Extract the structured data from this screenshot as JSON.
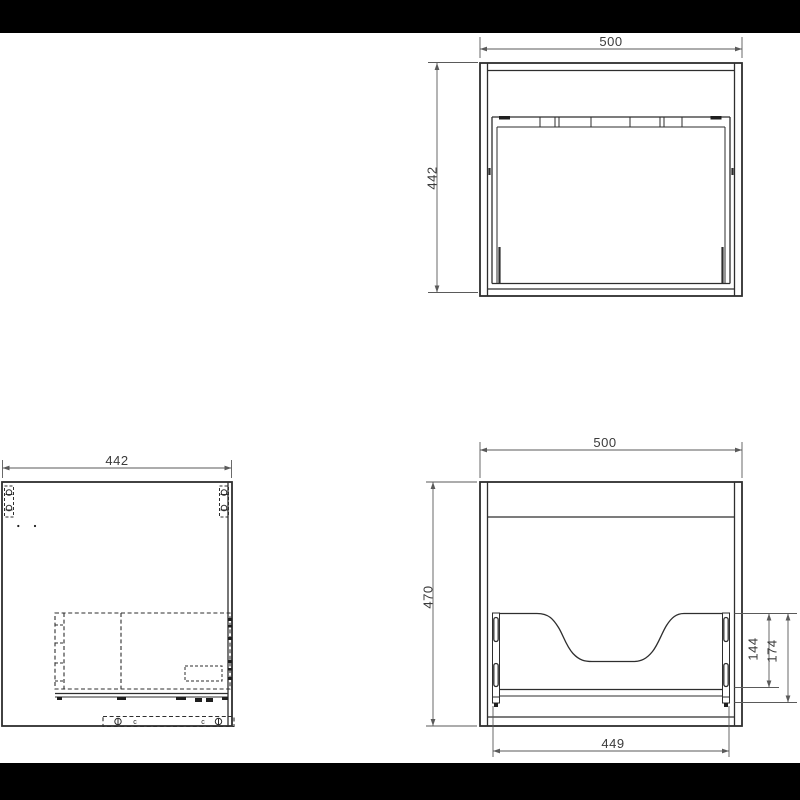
{
  "drawing": {
    "background": "#ffffff",
    "letterbox_color": "#000000",
    "line_color": "#2e2e2e",
    "dim_line_color": "#5a5a5a",
    "dim_text_color": "#3b3b3b",
    "views": {
      "top": {
        "width": "500",
        "depth": "442"
      },
      "side": {
        "depth": "442",
        "fastener_mark": "c"
      },
      "front": {
        "width": "500",
        "height": "470",
        "recess_height": "144",
        "back_panel_height": "174",
        "inner_width": "449"
      }
    }
  }
}
